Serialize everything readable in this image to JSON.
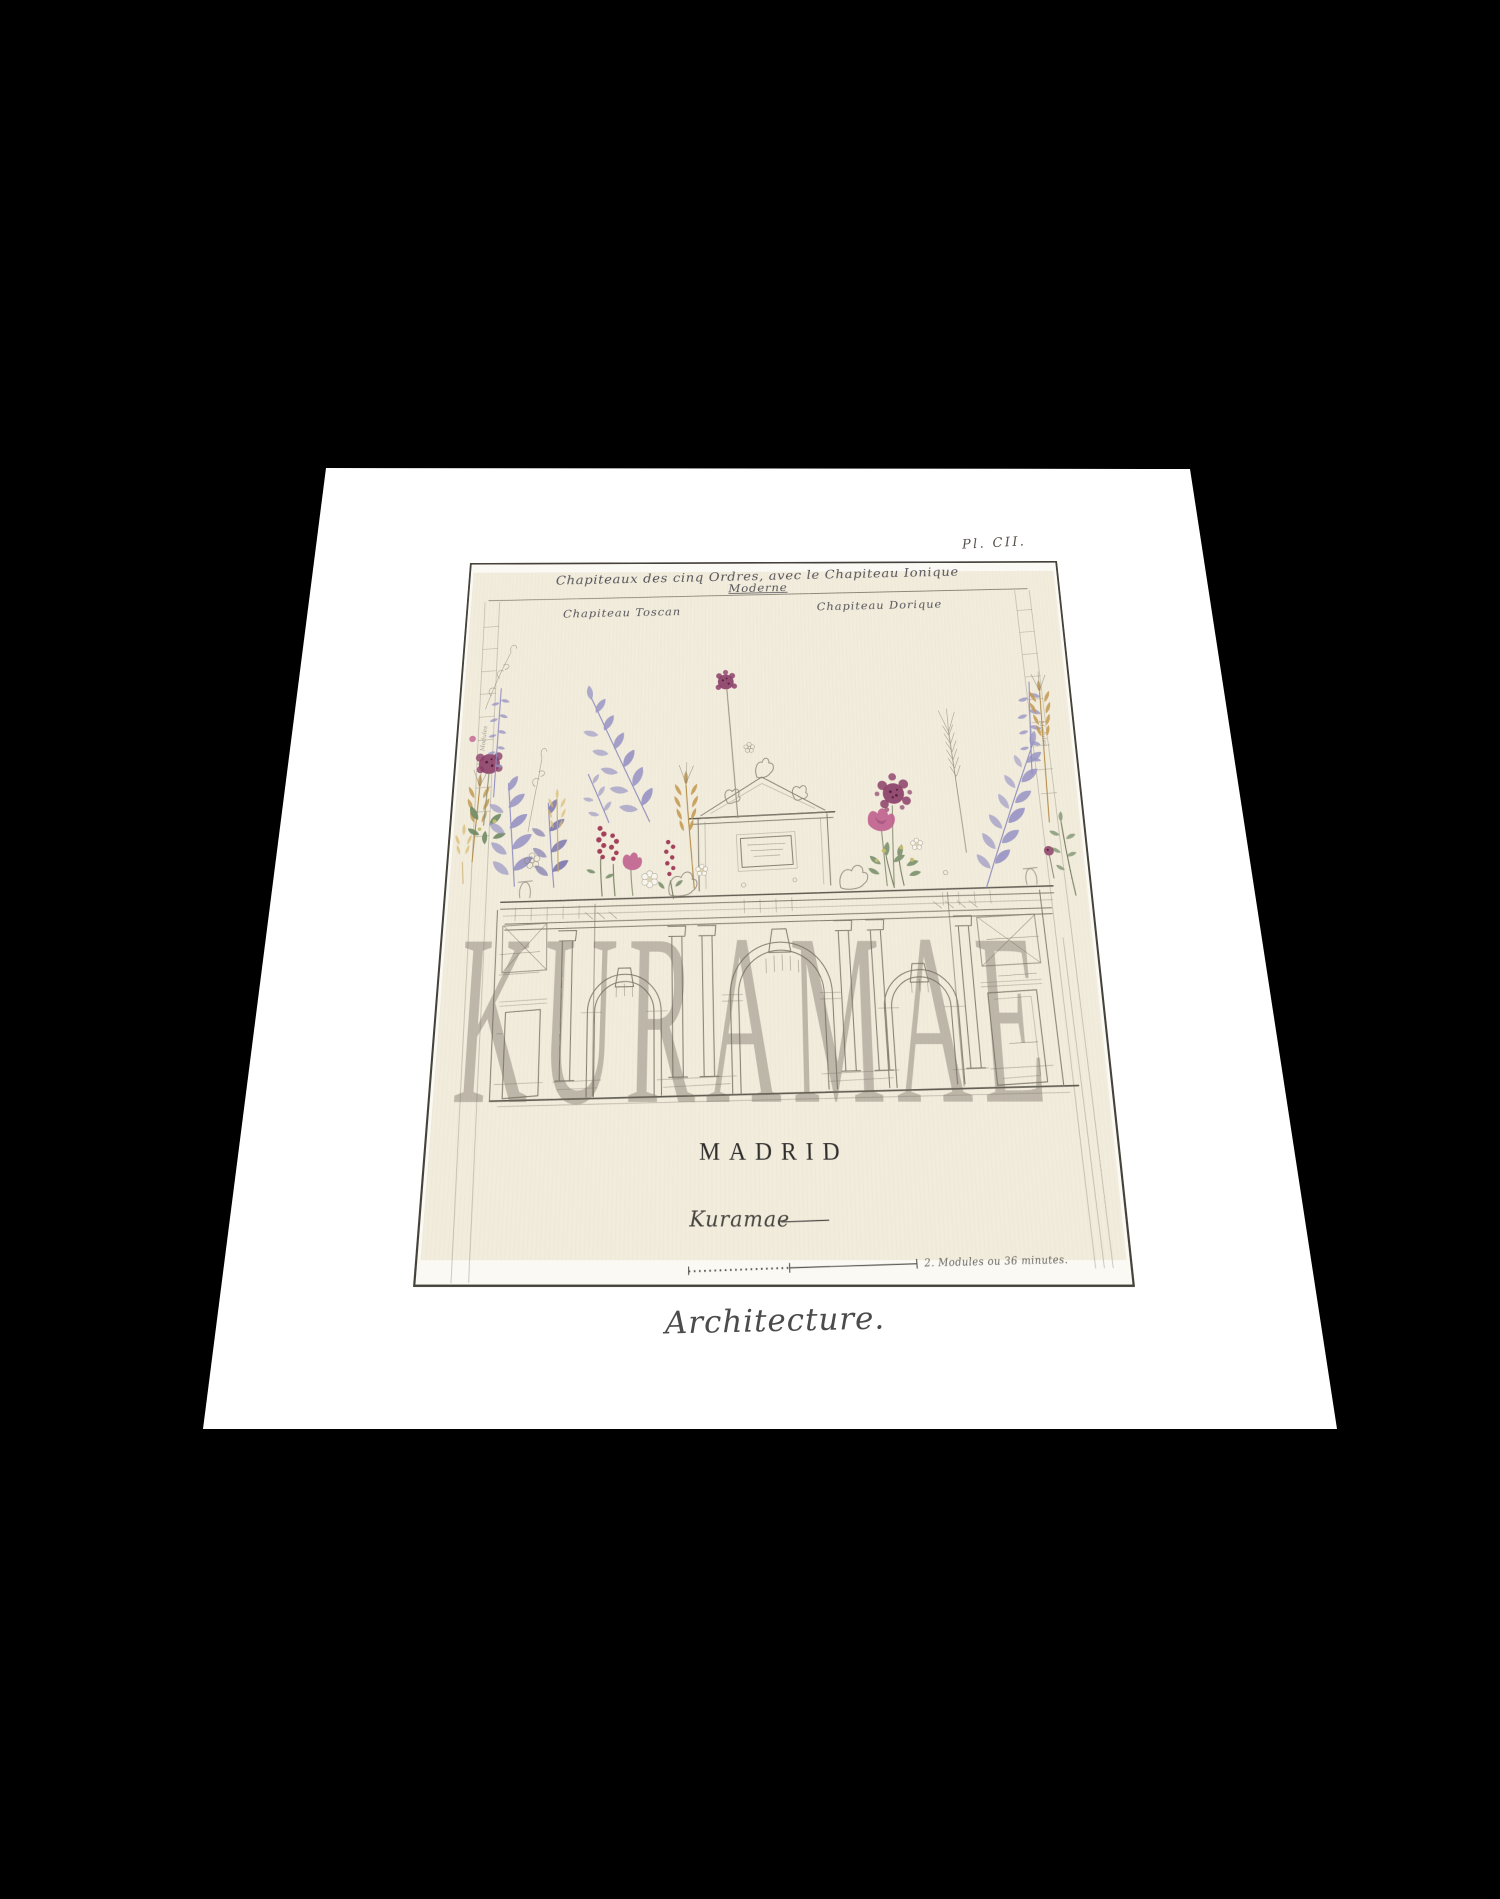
{
  "artwork": {
    "plate_number": "Pl. CII.",
    "header": {
      "title_line1": "Chapiteaux des cinq Ordres, avec le Chapiteau Ionique",
      "title_line2": "Moderne",
      "label_left": "Chapiteau Toscan",
      "label_right": "Chapiteau Dorique"
    },
    "city_title": "MADRID",
    "signature": "Kuramae",
    "scale_note": "2. Modules ou 36 minutes.",
    "margin_note_left": "Modules",
    "margin_note_right": "Modules",
    "watermark": "KURAMAE",
    "series_caption": "Architecture.",
    "colors": {
      "background": "#000000",
      "paper": "#ffffff",
      "plate_bg": "#f2ecdd",
      "ink": "#847e70",
      "text": "#3f3e46",
      "flower_plum": "#8c4069",
      "flower_pink": "#c0628f",
      "flower_lavender": "#9a97c4",
      "flower_wheat": "#c49a52",
      "flower_green": "#879a78",
      "flower_wine": "#a3405a",
      "watermark_gray": "rgba(112,105,92,0.40)"
    }
  }
}
